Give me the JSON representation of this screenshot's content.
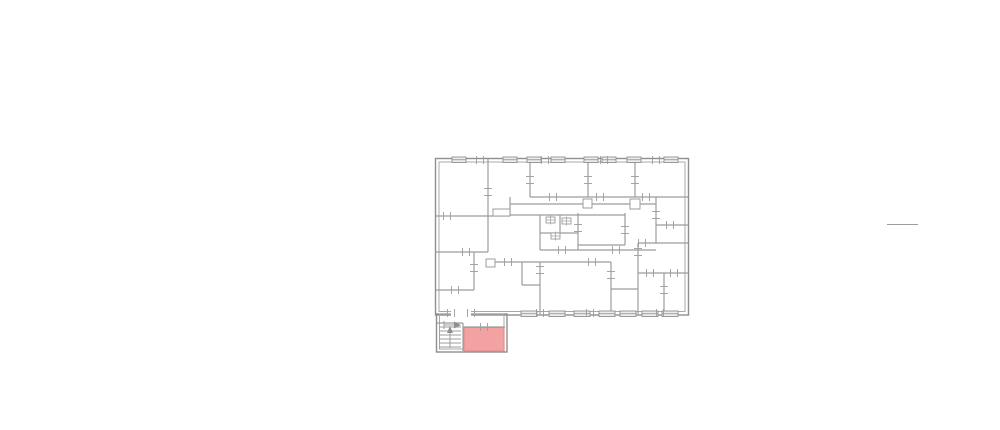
{
  "meta": {
    "title": "Apartment building floor plan with highlighted unit",
    "type": "architectural-floor-plan"
  },
  "canvas": {
    "width": 1000,
    "height": 430,
    "background": "#ffffff"
  },
  "palette": {
    "wall": "#8f8f8f",
    "wall_inner": "#a8a8a8",
    "wall_thin": "#9c9c9c",
    "window_fill": "#ececec",
    "highlight_fill": "#f3a2a2",
    "highlight_stroke": "#de8e8e",
    "annotation": "#9c9c9c"
  },
  "main_building": {
    "outer": [
      435.5,
      158.5,
      253,
      156.5
    ],
    "inner": [
      439,
      162,
      246,
      149.5
    ]
  },
  "annex": {
    "outer": [
      436.5,
      314,
      70.5,
      38
    ],
    "inner": [
      439.5,
      314,
      64.5,
      35
    ]
  },
  "highlight_room": {
    "rect": [
      464,
      327.5,
      40,
      23.5
    ]
  },
  "door_gaps": [
    [
      451,
      309,
      20,
      7
    ]
  ],
  "walls": [
    [
      436,
      216,
      510,
      216
    ],
    [
      436,
      252,
      488,
      252
    ],
    [
      436,
      290,
      474,
      290
    ],
    [
      530,
      197,
      688,
      197
    ],
    [
      510,
      204,
      656,
      204
    ],
    [
      510,
      215,
      625,
      215
    ],
    [
      540,
      233,
      578,
      233
    ],
    [
      578,
      245,
      625,
      245
    ],
    [
      540,
      250,
      656,
      250
    ],
    [
      656,
      225,
      688,
      225
    ],
    [
      638,
      243,
      688,
      243
    ],
    [
      638,
      273,
      688,
      273
    ],
    [
      488,
      262,
      611,
      262
    ],
    [
      522,
      285,
      540,
      285
    ],
    [
      611,
      289,
      638,
      289
    ],
    [
      437,
      323,
      463,
      323
    ],
    [
      463,
      327,
      505,
      327
    ],
    [
      488,
      159,
      488,
      252
    ],
    [
      474,
      252,
      474,
      290
    ],
    [
      530,
      159,
      530,
      197
    ],
    [
      510,
      197,
      510,
      216
    ],
    [
      588,
      159,
      588,
      197
    ],
    [
      635,
      159,
      635,
      197
    ],
    [
      656,
      197,
      656,
      243
    ],
    [
      638,
      243,
      638,
      314
    ],
    [
      664,
      273,
      664,
      314
    ],
    [
      540,
      215,
      540,
      250
    ],
    [
      578,
      213,
      578,
      250
    ],
    [
      560,
      215,
      560,
      233
    ],
    [
      625,
      213,
      625,
      245
    ],
    [
      522,
      262,
      522,
      285
    ],
    [
      540,
      262,
      540,
      314
    ],
    [
      611,
      262,
      611,
      314
    ],
    [
      463,
      323,
      463,
      351
    ]
  ],
  "boxes": [
    [
      493,
      209,
      17,
      7
    ],
    [
      486,
      259,
      9,
      8
    ],
    [
      583,
      199,
      9,
      9
    ],
    [
      630,
      199,
      10,
      10
    ]
  ],
  "fixtures": [
    [
      546,
      217,
      9,
      6
    ],
    [
      562,
      218,
      9,
      6
    ],
    [
      551,
      233,
      9,
      6
    ]
  ],
  "windows": {
    "top": {
      "y": 157,
      "h": 5.5,
      "w": 14,
      "centers": [
        459,
        510,
        534,
        558,
        591,
        609,
        634,
        671
      ]
    },
    "bottom": {
      "y": 311,
      "h": 5.5,
      "w": 16,
      "centers": [
        529,
        557,
        582,
        607,
        628,
        650,
        670
      ]
    }
  },
  "ticks": {
    "vertical_strokes": [
      [
        447,
        216
      ],
      [
        466,
        252
      ],
      [
        455,
        290
      ],
      [
        553,
        197
      ],
      [
        600,
        197
      ],
      [
        646,
        197
      ],
      [
        562,
        250
      ],
      [
        616,
        250
      ],
      [
        508,
        262
      ],
      [
        592,
        262
      ],
      [
        642,
        243
      ],
      [
        650,
        273
      ],
      [
        674,
        273
      ],
      [
        670,
        225
      ],
      [
        480,
        160
      ],
      [
        545,
        160
      ],
      [
        604,
        160
      ],
      [
        656,
        160
      ],
      [
        540,
        313
      ],
      [
        590,
        313
      ],
      [
        660,
        313
      ],
      [
        484,
        327
      ],
      [
        451,
        313
      ],
      [
        471,
        313
      ]
    ],
    "horizontal_strokes": [
      [
        488,
        192
      ],
      [
        638,
        252
      ],
      [
        656,
        215
      ],
      [
        611,
        275
      ],
      [
        540,
        270
      ],
      [
        578,
        228
      ],
      [
        625,
        230
      ],
      [
        664,
        290
      ],
      [
        474,
        268
      ],
      [
        530,
        180
      ],
      [
        588,
        180
      ],
      [
        635,
        180
      ]
    ]
  },
  "stairs": {
    "treads": {
      "x1": 439,
      "x2": 461,
      "ys": [
        327,
        331,
        335,
        339,
        343,
        347
      ]
    },
    "walk_line": [
      450,
      348,
      450,
      330
    ],
    "walk_arrow": [
      [
        450,
        326
      ],
      [
        447,
        333
      ],
      [
        453,
        333
      ]
    ],
    "entry_arrow": {
      "line": [
        444,
        325,
        457,
        325
      ],
      "head": [
        [
          461,
          325
        ],
        [
          454,
          321.5
        ],
        [
          454,
          328.5
        ]
      ],
      "bar": [
        444,
        321,
        444,
        329
      ]
    }
  },
  "annotation_line": [
    887,
    224.5,
    918,
    224.5
  ]
}
